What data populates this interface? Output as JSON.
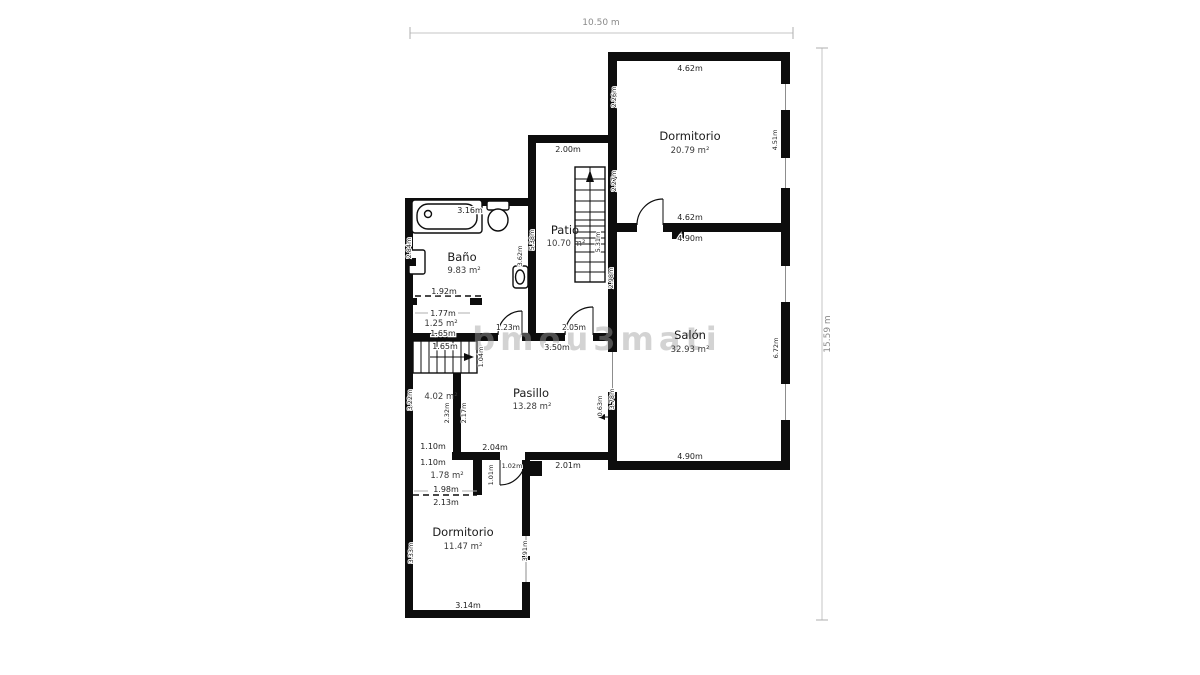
{
  "watermark": "bmou3mati",
  "overall": {
    "width_label": "10.50 m",
    "height_label": "15.59 m"
  },
  "rooms": {
    "dormitorio1": {
      "name": "Dormitorio",
      "area": "20.79 m²"
    },
    "salon": {
      "name": "Salón",
      "area": "32.93 m²"
    },
    "patio": {
      "name": "Patio",
      "area": "10.70 m²"
    },
    "bano": {
      "name": "Baño",
      "area": "9.83 m²"
    },
    "pasillo": {
      "name": "Pasillo",
      "area": "13.28 m²"
    },
    "dormitorio2": {
      "name": "Dormitorio",
      "area": "11.47 m²"
    },
    "closet_bano": {
      "area": "1.25 m²"
    },
    "trastero": {
      "area": "4.02 m²"
    },
    "closet_dorm2": {
      "area": "1.78 m²"
    }
  },
  "dims": {
    "d1_top": "4.62m",
    "d1_bottom": "4.62m",
    "d1_left_upper": "2.26m",
    "d1_left_lower": "2.27m",
    "d1_right": "4.51m",
    "salon_top": "4.90m",
    "salon_bottom": "4.90m",
    "salon_left_upper": "2.98m",
    "salon_left_lower": "3.78m",
    "salon_right": "6.72m",
    "salon_door": "0.63m",
    "patio_top": "2.00m",
    "patio_left": "5.38m",
    "patio_right": "5.31m",
    "patio_door": "2.05m",
    "bano_top": "3.16m",
    "bano_left": "2.84m",
    "bano_right": "3.62m",
    "closet_top": "1.92m",
    "closet_mid": "1.77m",
    "closet_bottom": "1.65m",
    "closet_door": "1.23m",
    "stairs_width": "1.65m",
    "stairs_depth": "1.04m",
    "trastero_left": "3.22m",
    "trastero_inner": "2.32m",
    "pasillo_inner": "2.17m",
    "trastero_bottom": "1.10m",
    "pasillo_top": "3.50m",
    "pasillo_bottom_left": "2.04m",
    "pasillo_bottom_right": "2.01m",
    "pasillo_door": "1.02m",
    "pasillo_door_leaf": "1.01m",
    "d2_top": "1.10m",
    "d2_closet_width": "1.98m",
    "d2_closet_below": "2.13m",
    "d2_left": "3.33m",
    "d2_right": "3.91m",
    "d2_bottom": "3.14m"
  }
}
